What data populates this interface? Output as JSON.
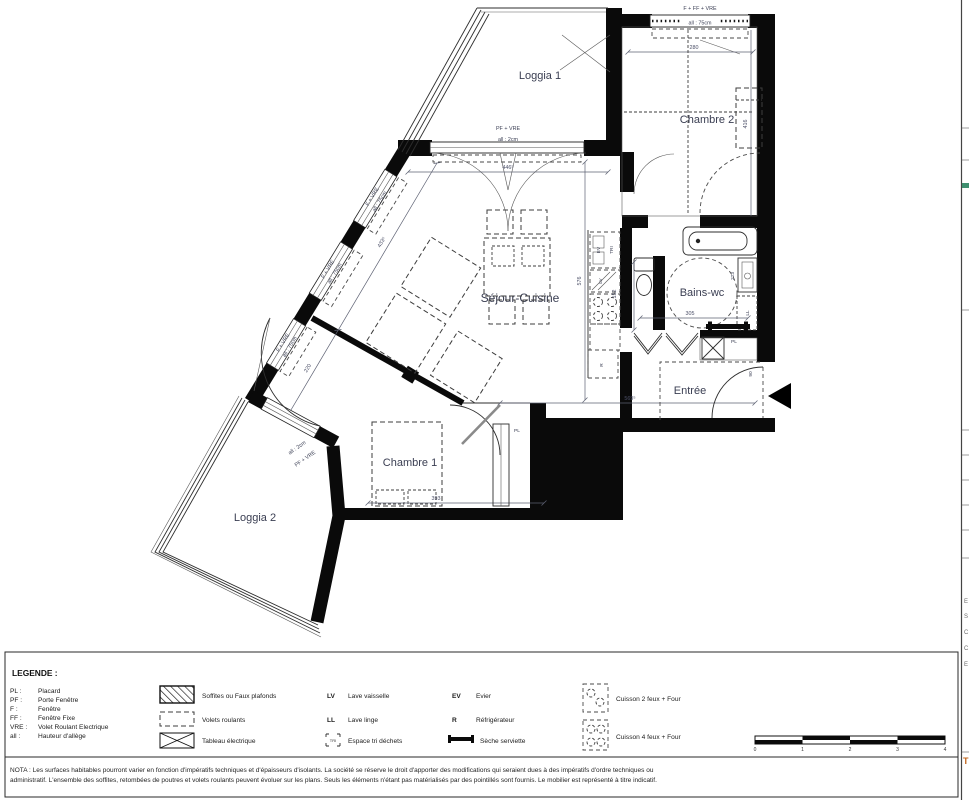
{
  "palette": {
    "wall": "#0a0a0a",
    "label": "#3a3e52",
    "dim": "#4c5068",
    "accent_tab": "#c2661d",
    "paper": "#ffffff",
    "teal_mark": "#3f8f6f"
  },
  "plan": {
    "rooms": {
      "loggia1": "Loggia 1",
      "chambre2": "Chambre 2",
      "sejour": "Séjour-Cuisine",
      "bains": "Bains-wc",
      "entree": "Entrée",
      "chambre1": "Chambre 1",
      "loggia2": "Loggia 2"
    },
    "openings": {
      "top_window": "F + FF + VRE",
      "top_window_sill": "all : 75cm",
      "loggia1_door": "PF + VRE",
      "loggia1_door_sill": "all : 2cm",
      "facade_window": "F + VRE",
      "facade_window_sill": "all : 75cm",
      "loggia2_door": "PF + VRE",
      "loggia2_door_sill": "all : 2cm"
    },
    "dims": {
      "chambre2_width": "280",
      "chambre2_depth": "416",
      "sejour_top": "446⁵",
      "sejour_height": "576",
      "bottom": "569⁵",
      "facade_upper": "433⁵",
      "facade_lower": "220",
      "wc": "152",
      "bains": "305",
      "bath_cabinet": "223",
      "chambre1": "393",
      "entry_door": "90"
    },
    "fixtures": {
      "sink": "EV",
      "sorting": "TRI",
      "dishwasher": "LV",
      "fridge": "R",
      "washer": "LL",
      "closet_hall": "PL",
      "closet_ch1": "PL"
    }
  },
  "legend": {
    "title": "LEGENDE :",
    "abbreviations": [
      {
        "abbr": "PL :",
        "label": "Placard"
      },
      {
        "abbr": "PF :",
        "label": "Porte Fenêtre"
      },
      {
        "abbr": "F :",
        "label": "Fenêtre"
      },
      {
        "abbr": "FF :",
        "label": "Fenêtre Fixe"
      },
      {
        "abbr": "VRE :",
        "label": "Volet Roulant Electrique"
      },
      {
        "abbr": "all :",
        "label": "Hauteur d'allège"
      }
    ],
    "symbols": [
      {
        "label": "Soffites ou Faux plafonds"
      },
      {
        "label": "Volets roulants"
      },
      {
        "label": "Tableau électrique"
      }
    ],
    "appliance_codes": [
      {
        "abbr": "LV",
        "label": "Lave vaisselle"
      },
      {
        "abbr": "LL",
        "label": "Lave linge"
      },
      {
        "abbr": "TRI",
        "label": "Espace tri déchets"
      }
    ],
    "appliance_codes2": [
      {
        "abbr": "EV",
        "label": "Evier"
      },
      {
        "abbr": "R",
        "label": "Réfrigérateur"
      },
      {
        "abbr": "",
        "label": "Sèche serviette"
      }
    ],
    "cooking": [
      {
        "label": "Cuisson 2 feux + Four"
      },
      {
        "label": "Cuisson 4 feux + Four"
      }
    ]
  },
  "scale_bar": {
    "ticks": [
      "0",
      "1",
      "2",
      "3",
      "4"
    ]
  },
  "nota": {
    "line1": "NOTA : Les surfaces habitables pourront varier en fonction d'impératifs techniques et d'épaisseurs d'isolants. La société se réserve le droit d'apporter des modifications qui seraient dues à des impératifs d'ordre techniques ou",
    "line2": "administratif. L'ensemble des soffites, retombées de poutres et volets roulants peuvent évoluer sur les plans. Seuls les éléments n'étant pas matérialisés par des pointillés sont fournis. Le mobilier est représenté à titre indicatif."
  },
  "side_panel": {
    "letters": [
      "E",
      "S",
      "C",
      "C",
      "E"
    ],
    "tab": "T"
  }
}
